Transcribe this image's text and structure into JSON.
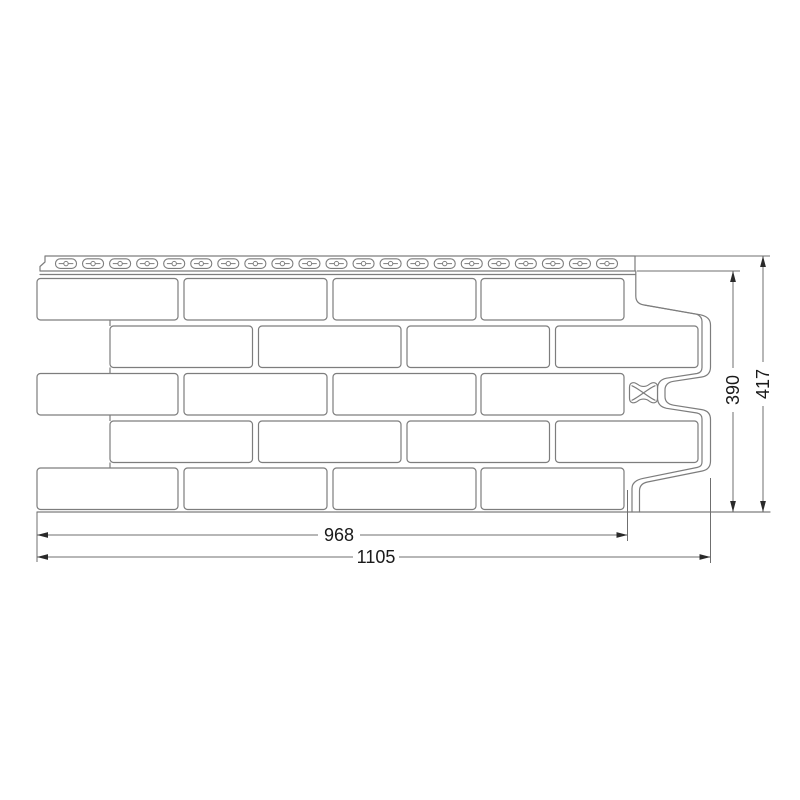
{
  "diagram": {
    "type": "technical-drawing",
    "subject": "brick-pattern facade panel, front view with dimensions",
    "colors": {
      "background": "#ffffff",
      "line": "#7d7d7d",
      "dim_line": "#6f6f6f",
      "arrow": "#2a2a2a",
      "text": "#1a1a1a"
    },
    "nail_strip": {
      "slot_count": 21,
      "marker": "bowtie-lock-marker"
    },
    "dimensions": {
      "total_width": "1105",
      "lock_width": "968",
      "total_height": "417",
      "brick_field_height": "390"
    }
  }
}
